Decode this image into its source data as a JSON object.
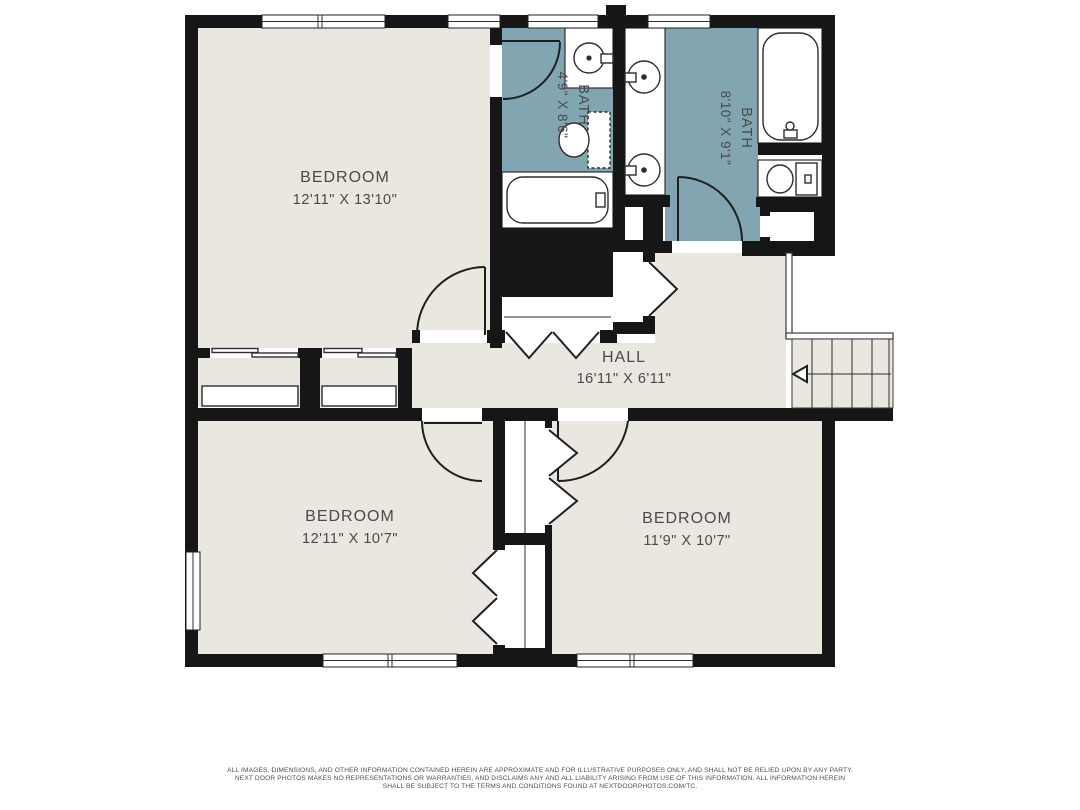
{
  "colors": {
    "wall": "#161616",
    "floor": "#e9e7df",
    "bath": "#81a6b1",
    "line": "#2e2e2e",
    "text": "#4a4a4a",
    "footer": "#4f4f4f",
    "bg": "#ffffff"
  },
  "floorplan": {
    "rooms": [
      {
        "id": "bedroom-top-left",
        "name": "BEDROOM",
        "dims": "12'11\" X 13'10\""
      },
      {
        "id": "bath-small",
        "name": "BATH",
        "dims": "4'9\" X 8'6\""
      },
      {
        "id": "bath-large",
        "name": "BATH",
        "dims": "8'10\" X 9'1\""
      },
      {
        "id": "hall",
        "name": "HALL",
        "dims": "16'11\" X 6'11\""
      },
      {
        "id": "bedroom-bottom-left",
        "name": "BEDROOM",
        "dims": "12'11\" X 10'7\""
      },
      {
        "id": "bedroom-bottom-right",
        "name": "BEDROOM",
        "dims": "11'9\" X 10'7\""
      }
    ]
  },
  "footer": {
    "line1": "ALL IMAGES, DIMENSIONS, AND OTHER INFORMATION CONTAINED HEREIN ARE APPROXIMATE AND FOR ILLUSTRATIVE PURPOSES ONLY, AND SHALL NOT BE RELIED UPON BY ANY PARTY.",
    "line2": "NEXT DOOR PHOTOS MAKES NO REPRESENTATIONS OR WARRANTIES, AND DISCLAIMS ANY AND ALL LIABILITY ARISING FROM USE OF THIS INFORMATION. ALL INFORMATION HEREIN",
    "line3": "SHALL BE SUBJECT TO THE TERMS AND CONDITIONS FOUND AT NEXTDOORPHOTOS.COM/TC."
  }
}
